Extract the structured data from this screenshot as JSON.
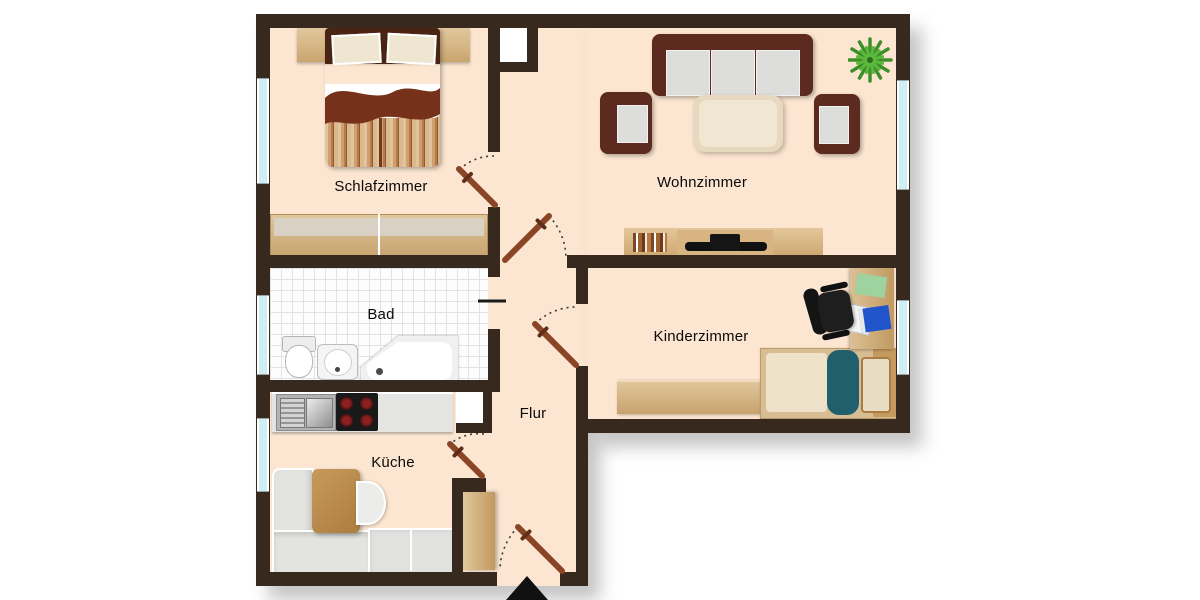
{
  "plan": {
    "title": "Apartment floor plan",
    "rooms": [
      {
        "id": "schlafzimmer",
        "label": "Schlafzimmer",
        "furniture": [
          "double-bed",
          "headboard-shelf",
          "wardrobe"
        ]
      },
      {
        "id": "wohnzimmer",
        "label": "Wohnzimmer",
        "furniture": [
          "sofa",
          "armchair-left",
          "armchair-right",
          "coffee-table",
          "tv-sideboard",
          "plant"
        ]
      },
      {
        "id": "bad",
        "label": "Bad",
        "furniture": [
          "toilet",
          "washbasin",
          "bathtub"
        ]
      },
      {
        "id": "kinderzimmer",
        "label": "Kinderzimmer",
        "furniture": [
          "desk",
          "office-chair",
          "single-bed",
          "sideboard"
        ]
      },
      {
        "id": "flur",
        "label": "Flur",
        "furniture": [
          "hall-wardrobe"
        ]
      },
      {
        "id": "kueche",
        "label": "Küche",
        "furniture": [
          "kitchen-counter",
          "sink",
          "stove",
          "dining-table",
          "corner-bench",
          "chair",
          "counter"
        ]
      }
    ],
    "doors": [
      "schlafzimmer-door",
      "wohnzimmer-door",
      "bad-door",
      "kinderzimmer-door",
      "kueche-door",
      "entrance-door"
    ],
    "entrance": {
      "marker": "black-triangle-arrow",
      "direction": "up"
    },
    "window_count": 5,
    "colors": {
      "background": "#ffffff",
      "wall": "#38291e",
      "floor": "#fce6d1",
      "wood": "#d2ab74",
      "upholstery_dark": "#5c2a1f",
      "cushion_grey": "#dddddb",
      "window_glass": "#cdeef4",
      "teal_blanket": "#20606c",
      "door_leaf": "#8a4527",
      "plant_green": "#3e8f28"
    }
  }
}
